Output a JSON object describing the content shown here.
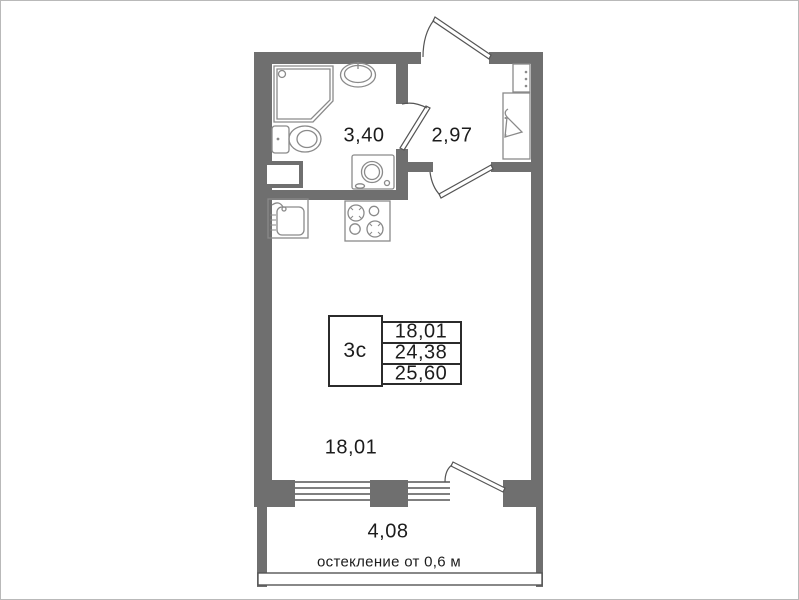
{
  "plan": {
    "rooms": [
      {
        "name": "bathroom",
        "area_label": "3,40"
      },
      {
        "name": "hallway",
        "area_label": "2,97"
      },
      {
        "name": "living-room",
        "area_label": "18,01"
      },
      {
        "name": "balcony",
        "area_label": "4,08"
      }
    ],
    "info_table": {
      "unit_type": "3с",
      "values": [
        "18,01",
        "24,38",
        "25,60"
      ]
    },
    "balcony_note": "остекление от 0,6 м",
    "colors": {
      "wall": "#6f6f6f",
      "outline": "#555555",
      "fixture_outline": "#8a8a8a",
      "table_border": "#2b2b2b",
      "text": "#1c1c1c"
    },
    "fixtures": [
      "shower-cabin",
      "bathroom-sink",
      "toilet",
      "washing-machine",
      "vent-shaft",
      "kitchen-sink",
      "stove",
      "wardrobe",
      "hanger",
      "entry-door",
      "bathroom-door",
      "room-door",
      "balcony-door",
      "window",
      "balcony-glazing"
    ]
  }
}
